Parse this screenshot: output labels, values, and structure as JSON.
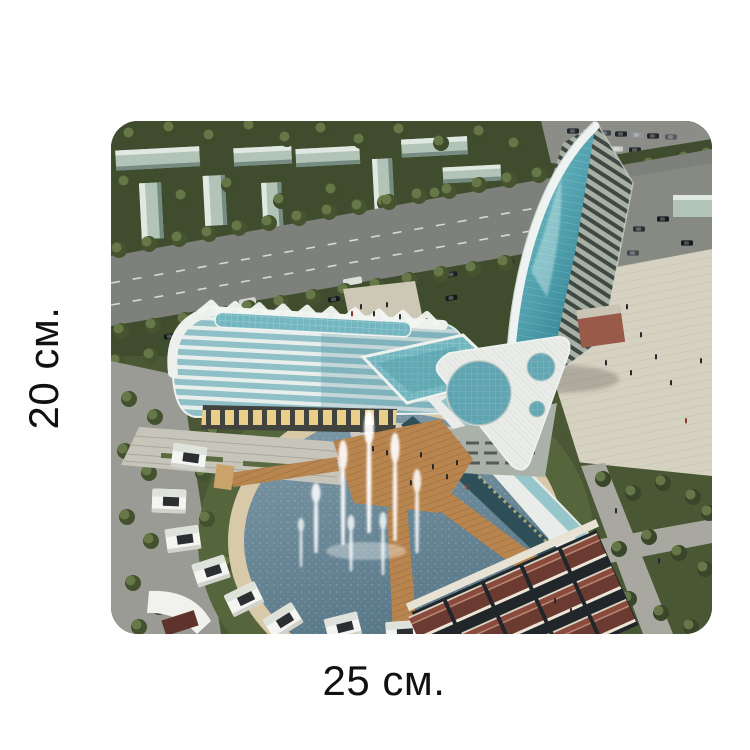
{
  "dimensions": {
    "height_label": "20 см.",
    "width_label": "25 см."
  },
  "figure": {
    "description": "Aerial architectural rendering: curved glass hotel complex with leaning glass tower, triangular roof building with round skylights, circular fountain pool with wooden piers, white pavilions, red-roofed row houses, tree-lined avenue"
  },
  "colors": {
    "background": "#ffffff",
    "label_text": "#111111",
    "park_green": "#3f4d2e",
    "lawn_green": "#55663c",
    "road_gray": "#7d807b",
    "pavement_gray": "#9b9b95",
    "plaza_beige": "#d6d2c2",
    "ring_beige": "#d8c9a9",
    "water_blue": "#6f8e9e",
    "glass_teal": "#74b6c0",
    "tower_glass": "#58a8b4",
    "building_white": "#e9ece8",
    "pale_block": "#b2c4b8",
    "wood_brown": "#b9854f",
    "roof_maroon": "#6b3a31",
    "window_glow": "#e9cf8a"
  }
}
